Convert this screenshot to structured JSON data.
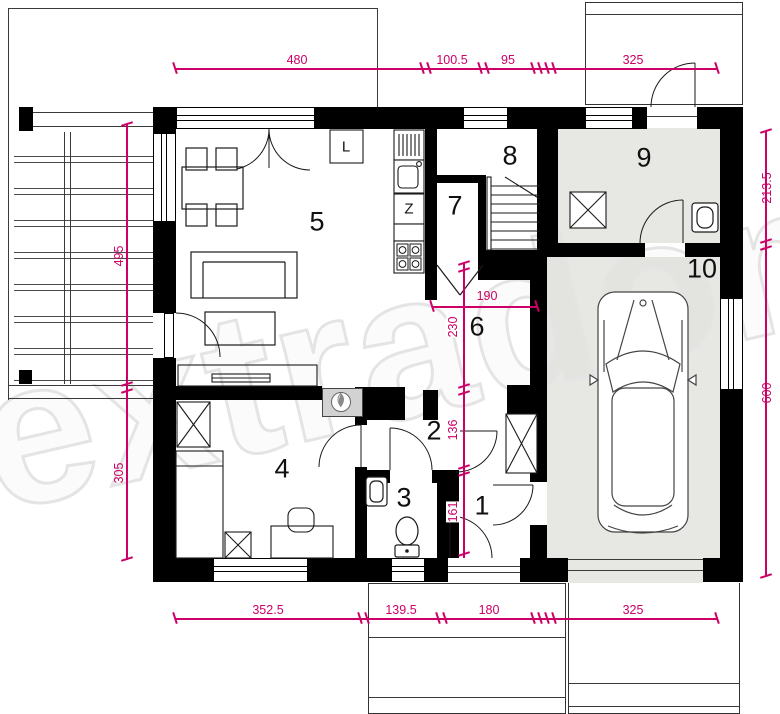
{
  "watermark": {
    "text": "extradom"
  },
  "colors": {
    "dimension": "#cc0066",
    "wall": "#000000",
    "garage_floor": "#e7e7e4",
    "watermark_outline": "#e4e4e4"
  },
  "rooms": {
    "r1": "1",
    "r2": "2",
    "r3": "3",
    "r4": "4",
    "r5": "5",
    "r6": "6",
    "r7": "7",
    "r8": "8",
    "r9": "9",
    "r10": "10"
  },
  "kitchen": {
    "fridge": "L",
    "dishwasher": "Z"
  },
  "dims": {
    "top": [
      "480",
      "100.5",
      "95",
      "325"
    ],
    "bottom": [
      "352.5",
      "139.5",
      "180",
      "325"
    ],
    "left": [
      "495",
      "305"
    ],
    "right": [
      "213.5",
      "600"
    ],
    "inner": [
      "190",
      "230",
      "136",
      "161"
    ]
  }
}
